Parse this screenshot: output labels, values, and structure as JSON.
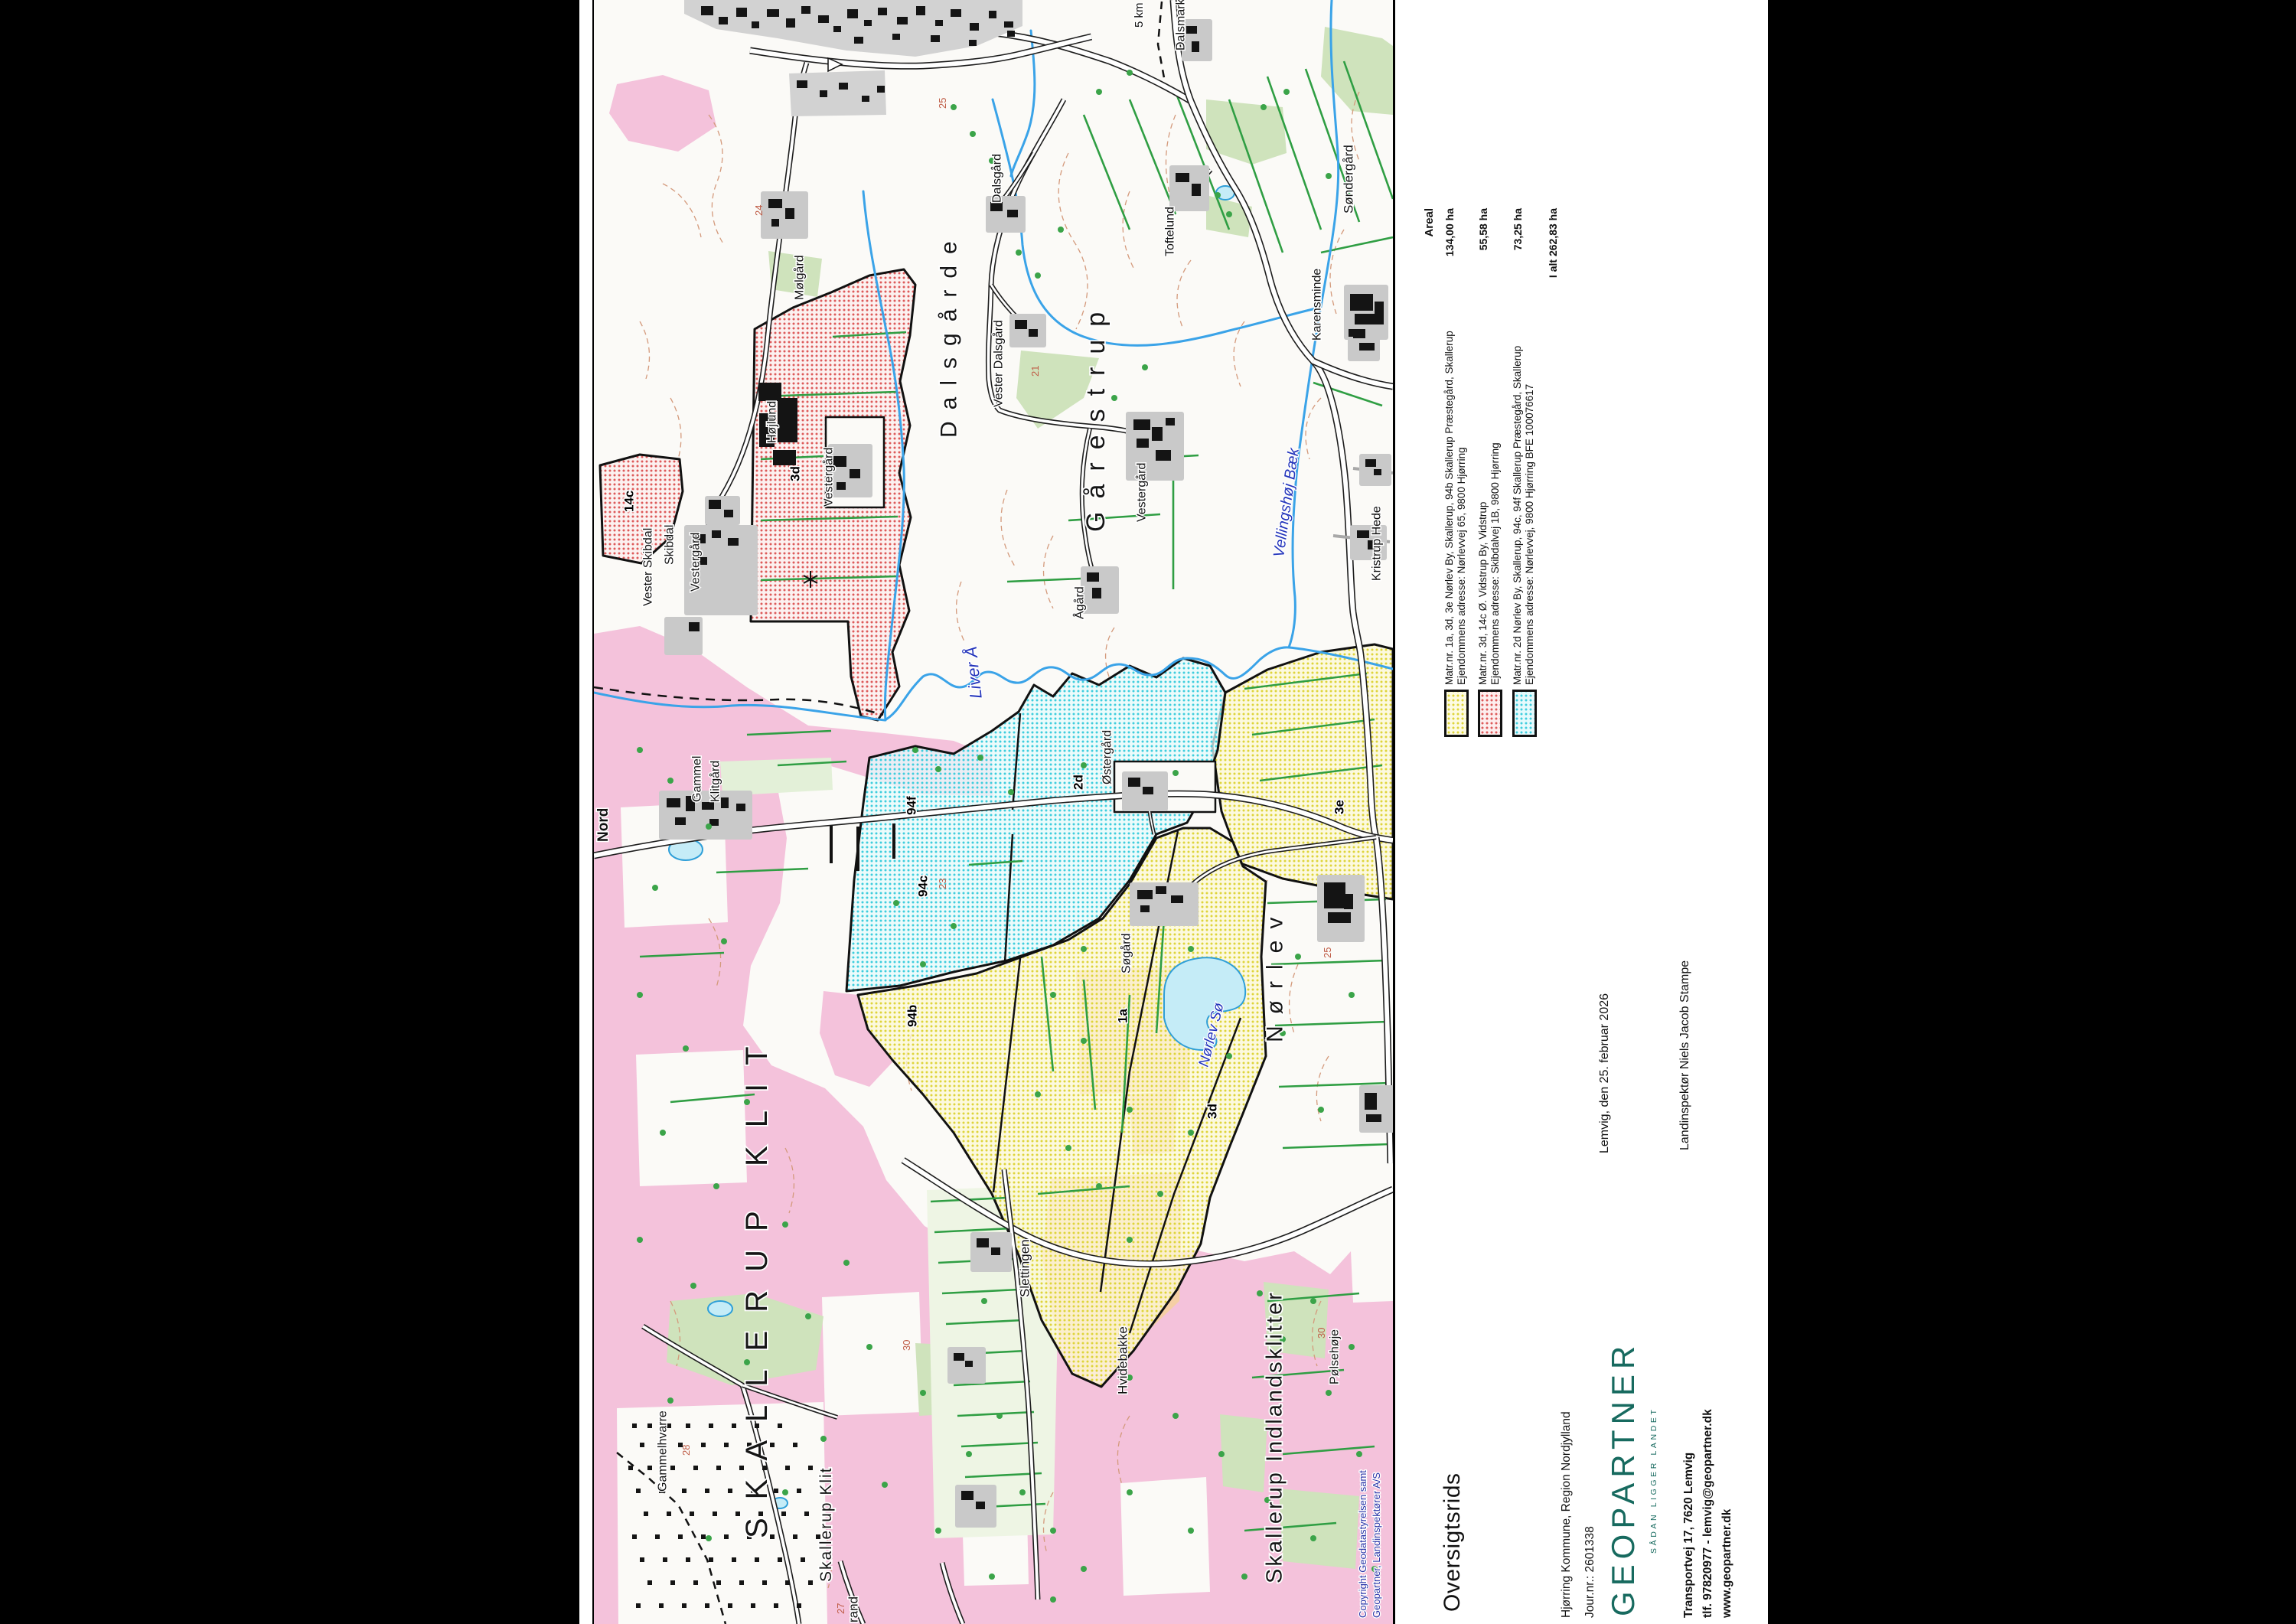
{
  "page": {
    "background": "#000000",
    "paper": "#ffffff"
  },
  "title_block": {
    "title": "Oversigtsrids",
    "municipality": "Hjørring Kommune, Region Nordjylland",
    "journal": "Jour.nr.: 2601338",
    "logo": "GEOPARTNER",
    "logo_sub": "SÅDAN LIGGER LANDET",
    "address1": "Transportvej 17, 7620 Lemvig",
    "address2": "tlf. 97820977 - lemvig@geopartner.dk",
    "address3": "www.geopartner.dk",
    "date_line": "Lemvig, den 25. februar 2026",
    "surveyor": "Landinspektør Niels Jacob Stampe"
  },
  "legend": {
    "areal_header": "Areal",
    "entries": [
      {
        "color": "#ded43a",
        "line1": "Matr.nr. 1a, 3d, 3e Nørlev By, Skallerup, 94b Skallerup Præstegård, Skallerup",
        "line2": "Ejendommens adresse: Nørlevvej 65, 9800 Hjørring",
        "areal": "134,00 ha"
      },
      {
        "color": "#dd5a5a",
        "line1": "Matr.nr. 3d, 14c Ø. Vidstrup By, Vidstrup",
        "line2": "Ejendommens adresse: Skibdalvej 1B, 9800 Hjørring",
        "areal": "55,58 ha"
      },
      {
        "color": "#3ecddd",
        "line1": "Matr.nr. 2d Nørlev By, Skallerup, 94c, 94f Skallerup Præstegård, Skallerup",
        "line2": "Ejendommens adresse: Nørlevvej, 9800 Hjørring BFE 100076617",
        "areal": "73,25 ha"
      }
    ],
    "total": "I alt 262,83 ha"
  },
  "map": {
    "copyright": [
      {
        "text": "Copyright Geodatastyrelsen samt",
        "u": 8,
        "v": 998
      },
      {
        "text": "Geopartner, Landinspektører A/S",
        "u": 8,
        "v": 1016
      }
    ],
    "place_labels": [
      {
        "text": "Nord",
        "u": 1022,
        "v": 2,
        "s": 19,
        "b": 1
      },
      {
        "text": "Gammel",
        "u": 1074,
        "v": 126,
        "s": 16
      },
      {
        "text": "Klitgård",
        "u": 1074,
        "v": 150,
        "s": 16
      },
      {
        "text": "Vester Skibdal",
        "u": 1330,
        "v": 62,
        "s": 16
      },
      {
        "text": "Skibdal",
        "u": 1384,
        "v": 90,
        "s": 16
      },
      {
        "text": "Vestergård",
        "u": 1349,
        "v": 124,
        "s": 16
      },
      {
        "text": "Vestergård",
        "u": 1460,
        "v": 298,
        "s": 16
      },
      {
        "text": "Højlund",
        "u": 1543,
        "v": 224,
        "s": 16
      },
      {
        "text": "Mølgård",
        "u": 1730,
        "v": 260,
        "s": 16
      },
      {
        "text": "Dalsgård",
        "u": 1857,
        "v": 518,
        "s": 16
      },
      {
        "text": "Vester Dalsgård",
        "u": 1590,
        "v": 520,
        "s": 16
      },
      {
        "text": "Toftelund",
        "u": 1787,
        "v": 744,
        "s": 16
      },
      {
        "text": "Dalsmark",
        "u": 2056,
        "v": 758,
        "s": 16
      },
      {
        "text": "5 km",
        "u": 2086,
        "v": 704,
        "s": 15
      },
      {
        "text": "Søndergård",
        "u": 1843,
        "v": 977,
        "s": 17
      },
      {
        "text": "Karensminde",
        "u": 1677,
        "v": 936,
        "s": 16
      },
      {
        "text": "Kristrup Hede",
        "u": 1363,
        "v": 1014,
        "s": 16
      },
      {
        "text": "Vestergård",
        "u": 1440,
        "v": 707,
        "s": 16
      },
      {
        "text": "Ågård",
        "u": 1313,
        "v": 626,
        "s": 16
      },
      {
        "text": "Østergård",
        "u": 1097,
        "v": 662,
        "s": 16
      },
      {
        "text": "Søgård",
        "u": 850,
        "v": 687,
        "s": 16
      },
      {
        "text": "Slettingen",
        "u": 427,
        "v": 554,
        "s": 17
      },
      {
        "text": "Hvidebakke",
        "u": 300,
        "v": 682,
        "s": 17
      },
      {
        "text": "Pølsehøje",
        "u": 313,
        "v": 959,
        "s": 16
      },
      {
        "text": "Gammelhvarre",
        "u": 173,
        "v": 81,
        "s": 16
      },
      {
        "text": "rand",
        "u": 2,
        "v": 330,
        "s": 17
      }
    ],
    "big_labels": [
      {
        "text": "Dalsgårde",
        "u": 1550,
        "v": 448,
        "s": 30,
        "ls": 15
      },
      {
        "text": "Gårestrup",
        "u": 1427,
        "v": 638,
        "s": 34,
        "ls": 17
      },
      {
        "text": "Nørlev",
        "u": 760,
        "v": 874,
        "s": 30,
        "ls": 15
      },
      {
        "text": "SKALLERUP KLIT",
        "u": 112,
        "v": 192,
        "s": 40,
        "ls": 24
      },
      {
        "text": "Skallerup Indlandsklitter",
        "u": 53,
        "v": 874,
        "s": 29,
        "ls": 3
      },
      {
        "text": "Skallerup Klit",
        "u": 55,
        "v": 292,
        "s": 21,
        "ls": 2
      }
    ],
    "water_labels": [
      {
        "text": "Liver Å",
        "u": 1210,
        "v": 488,
        "s": 22,
        "rot": -6
      },
      {
        "text": "Vellingshøj Bæk",
        "u": 1393,
        "v": 884,
        "s": 20,
        "rot": 8
      },
      {
        "text": "Nørlev Sø",
        "u": 727,
        "v": 786,
        "s": 19,
        "rot": 14
      }
    ],
    "parcel_labels": [
      {
        "text": "1a",
        "u": 785,
        "v": 682
      },
      {
        "text": "2d",
        "u": 1090,
        "v": 624
      },
      {
        "text": "3d",
        "u": 1493,
        "v": 254
      },
      {
        "text": "3d",
        "u": 660,
        "v": 799
      },
      {
        "text": "3e",
        "u": 1058,
        "v": 965
      },
      {
        "text": "14c",
        "u": 1453,
        "v": 37
      },
      {
        "text": "94f",
        "u": 1057,
        "v": 406
      },
      {
        "text": "94c",
        "u": 950,
        "v": 421
      },
      {
        "text": "94b",
        "u": 780,
        "v": 407
      }
    ],
    "contour_labels": [
      {
        "text": "21",
        "u": 1630,
        "v": 570
      },
      {
        "text": "23",
        "u": 960,
        "v": 449
      },
      {
        "text": "24",
        "u": 1840,
        "v": 209
      },
      {
        "text": "25",
        "u": 1980,
        "v": 449
      },
      {
        "text": "25",
        "u": 870,
        "v": 952
      },
      {
        "text": "27",
        "u": 13,
        "v": 316
      },
      {
        "text": "28",
        "u": 220,
        "v": 114
      },
      {
        "text": "30",
        "u": 357,
        "v": 402
      },
      {
        "text": "30",
        "u": 373,
        "v": 944
      }
    ],
    "colors": {
      "parcel_yellow": "#ded43a",
      "parcel_red": "#dd5a5a",
      "parcel_cyan": "#3ecddd",
      "heath_pink": "#f4c2db",
      "forest_green": "#cfe3bc",
      "field_line_green": "#2f9e43",
      "water_blue": "#3aa3e8",
      "contour_brown": "#d49a7c",
      "logo_teal": "#176a5f",
      "water_label_blue": "#2334bb"
    }
  }
}
